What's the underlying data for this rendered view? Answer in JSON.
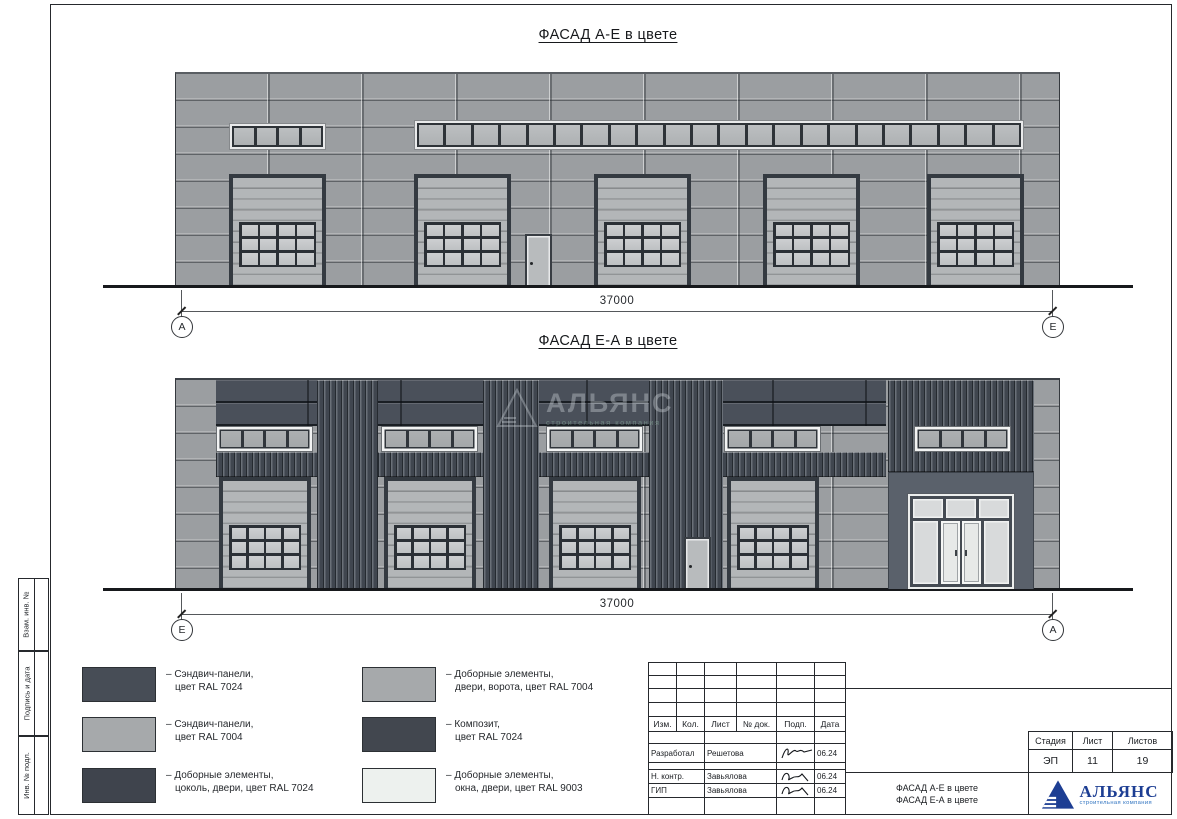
{
  "facade_top": {
    "title": "ФАСАД А-Е в цвете",
    "dimension": "37000",
    "axis_left": "А",
    "axis_right": "Е",
    "gate_count": 5,
    "small_band_panes": 4,
    "long_band_panes": 22,
    "gate_window_cols": 4,
    "gate_window_rows": 3
  },
  "facade_bottom": {
    "title": "ФАСАД Е-А в цвете",
    "dimension": "37000",
    "axis_left": "Е",
    "axis_right": "А",
    "gate_count": 4,
    "window_band_count": 5,
    "band_panes": 4,
    "gate_window_cols": 4,
    "gate_window_rows": 3
  },
  "watermark": {
    "name": "АЛЬЯНС",
    "subtitle": "строительная компания"
  },
  "legend": {
    "left": [
      {
        "color": "#474d56",
        "line1": "– Сэндвич-панели,",
        "line2": "цвет RAL 7024"
      },
      {
        "color": "#a6a9ab",
        "line1": "– Сэндвич-панели,",
        "line2": "цвет RAL 7004"
      },
      {
        "color": "#3f444d",
        "line1": "– Доборные элементы,",
        "line2": "цоколь, двери, цвет RAL 7024"
      }
    ],
    "right": [
      {
        "color": "#a6a9ab",
        "line1": "– Доборные элементы,",
        "line2": "двери, ворота, цвет RAL 7004"
      },
      {
        "color": "#42474f",
        "line1": "– Композит,",
        "line2": "цвет RAL 7024"
      },
      {
        "color": "#edf1ee",
        "line1": "– Доборные элементы,",
        "line2": "окна, двери, цвет RAL 9003"
      }
    ]
  },
  "sidebar": {
    "labels": [
      "Взам. инв. №",
      "Подпись и дата",
      "Инв. № подл."
    ]
  },
  "titleblock": {
    "header_cols": [
      "Изм.",
      "Кол.",
      "Лист",
      "№ док.",
      "Подп.",
      "Дата"
    ],
    "rows": [
      {
        "role": "Разработал",
        "name": "Решетова",
        "date": "06.24"
      },
      {
        "role": "Н. контр.",
        "name": "Завьялова",
        "date": "06.24"
      },
      {
        "role": "ГИП",
        "name": "Завьялова",
        "date": "06.24"
      }
    ],
    "stage_label": "Стадия",
    "sheet_label": "Лист",
    "sheets_label": "Листов",
    "stage_value": "ЭП",
    "sheet_value": "11",
    "sheets_value": "19",
    "doc_title_line1": "ФАСАД А-Е в цвете",
    "doc_title_line2": "ФАСАД Е-А в цвете",
    "logo_name": "АЛЬЯНС",
    "logo_subtitle": "строительная компания"
  }
}
